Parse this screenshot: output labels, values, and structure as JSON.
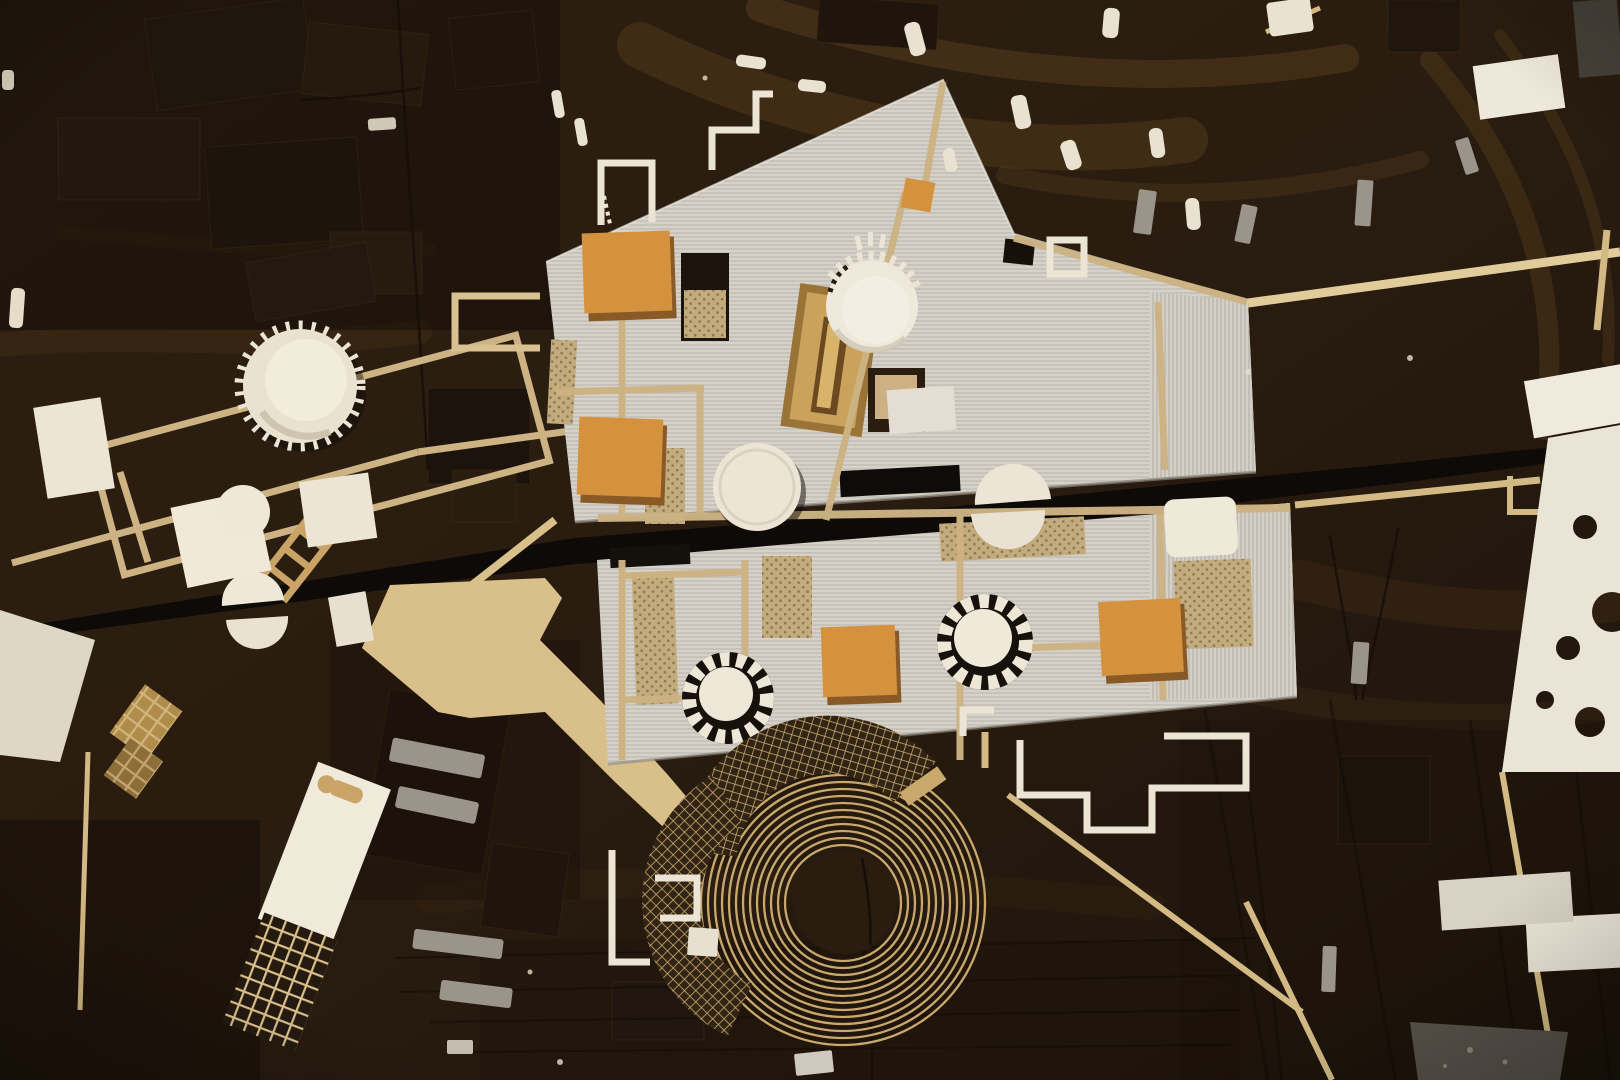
{
  "scene": {
    "type": "photograph",
    "subject": "Top-down view of a wooden architectural site model on a dark stained timber base",
    "medium": "laser-cut wood, card and 3D-printed model pieces"
  },
  "palette": {
    "wood_dark": "#281c10",
    "wood_mid": "#3c2b18",
    "wood_light": "#6e5024",
    "plate_gray": "#d6d2c9",
    "plate_rib": "#a8a399",
    "strip_tan": "#cdb383",
    "plaza_tan": "#d9c08b",
    "cube_orange": "#d4923f",
    "panel_wood": "#bd914f",
    "dotted_floor": "#c2ab7c",
    "cream": "#ece5d6",
    "band_black": "#0d0a07",
    "spiral_tan": "#c8a86c",
    "bar_gray": "#9a948a"
  },
  "elements": [
    {
      "name": "wood-base-board",
      "desc": "dark stained wooden base with carved terrain blocks"
    },
    {
      "name": "main-roof-plate-upper",
      "desc": "large corrugated grey roof plate, upper half"
    },
    {
      "name": "main-roof-plate-lower",
      "desc": "large corrugated grey roof plate, lower half"
    },
    {
      "name": "black-road-band",
      "desc": "black diagonal infrastructure band crossing the site"
    },
    {
      "name": "orange-cube-block",
      "desc": "orange timber cube volumes on the roof plate"
    },
    {
      "name": "crowned-cylinder-tower",
      "desc": "white cylindrical tower with serrated crown, top left"
    },
    {
      "name": "dome-with-colonnade",
      "desc": "white dome ringed by small posts"
    },
    {
      "name": "split-dome",
      "desc": "white dome cut in two by the black band"
    },
    {
      "name": "ring-tower",
      "desc": "white cylinder with black segmented gear ring"
    },
    {
      "name": "spiral-amphitheater",
      "desc": "large circular laser-cut spiral / amphitheater"
    },
    {
      "name": "tan-plaza-ramp",
      "desc": "flat tan plywood plaza with diagonal ramp to the spiral"
    },
    {
      "name": "dotted-floor-opening",
      "desc": "roof openings revealing dotted tan floors"
    },
    {
      "name": "wood-courtyard-panel",
      "desc": "sunken timber courtyard panel"
    },
    {
      "name": "tan-strip-road",
      "desc": "thin tan timber strips forming paths and frames"
    },
    {
      "name": "white-meander-wall",
      "desc": "white Greek-key meander walls"
    },
    {
      "name": "white-building-block",
      "desc": "small white massing blocks"
    },
    {
      "name": "white-pill-block",
      "desc": "tiny white capsule-shaped buildings"
    },
    {
      "name": "gray-bar-building",
      "desc": "small grey bar buildings"
    },
    {
      "name": "perforated-white-sheet",
      "desc": "white sheet with round holes, right edge"
    },
    {
      "name": "waffle-grid-building",
      "desc": "long white slab with laser-cut waffle grid"
    },
    {
      "name": "mesh-gold-block",
      "desc": "small perforated golden mesh blocks"
    },
    {
      "name": "ladder-piece",
      "desc": "small wooden ladder-like frame"
    }
  ]
}
